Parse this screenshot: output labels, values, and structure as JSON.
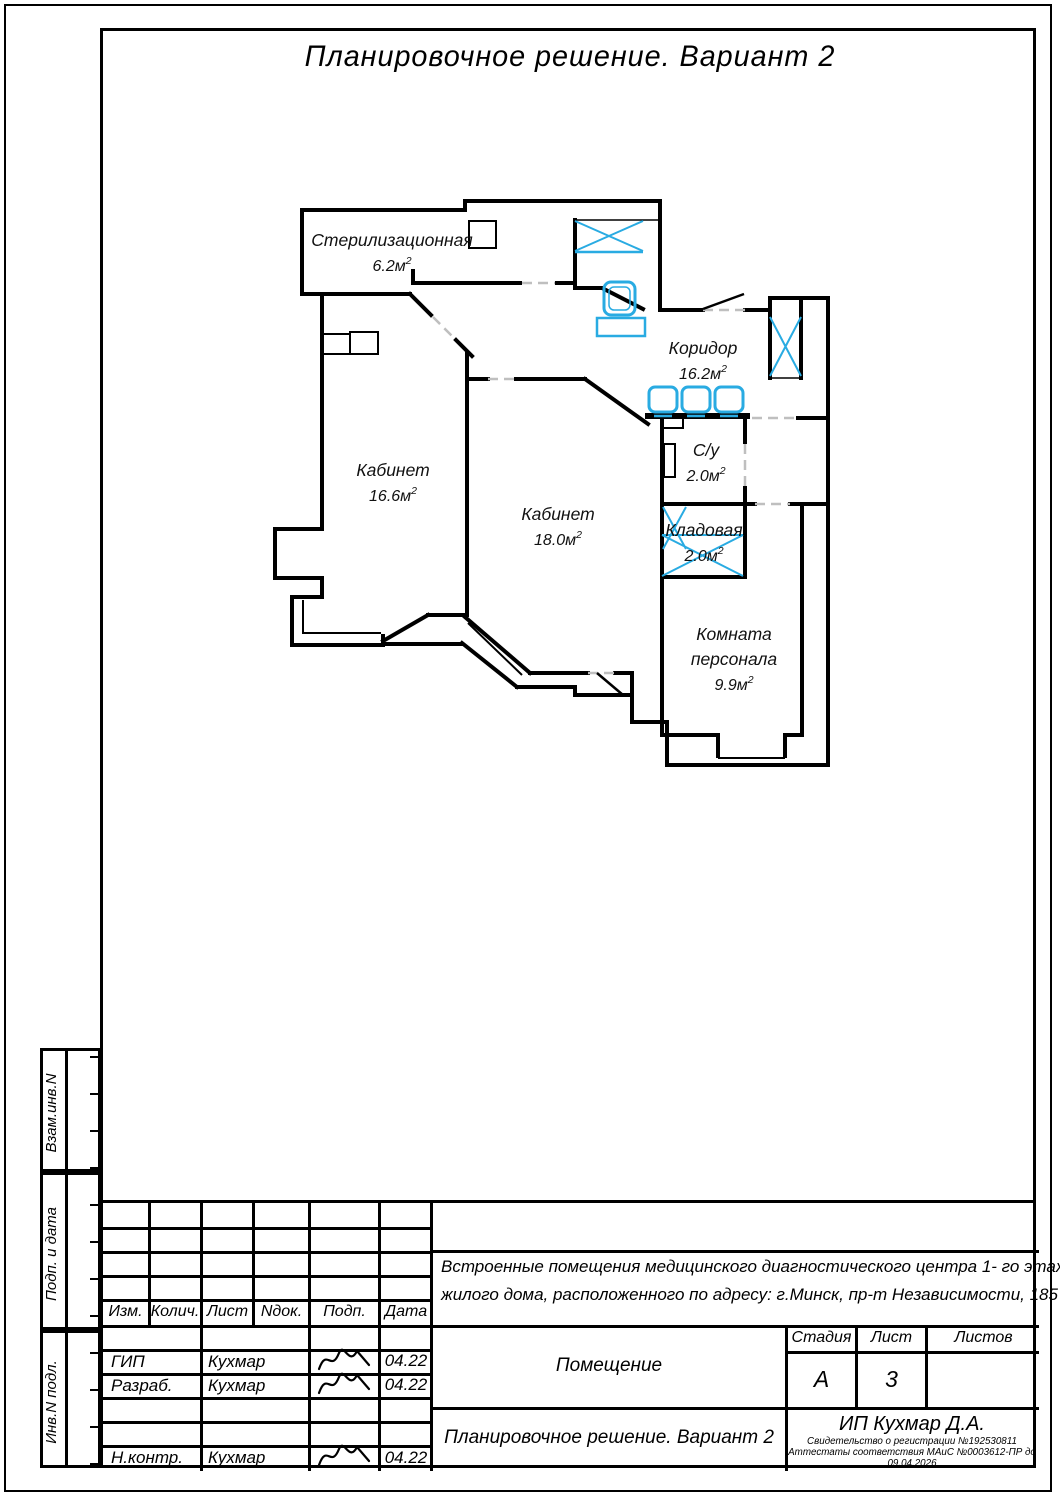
{
  "sheet_title": "Планировочное решение. Вариант 2",
  "colors": {
    "accent_blue": "#29ABE2",
    "line_black": "#000000"
  },
  "floor_plan": {
    "area_unit": "м",
    "area_sup": "2",
    "rooms": [
      {
        "name": "Стерилизационная",
        "area": "6.2",
        "x": 122,
        "y": 56
      },
      {
        "name": "Кабинет",
        "area": "16.6",
        "x": 123,
        "y": 286
      },
      {
        "name": "Кабинет",
        "area": "18.0",
        "x": 288,
        "y": 330
      },
      {
        "name": "Коридор",
        "area": "16.2",
        "x": 433,
        "y": 164
      },
      {
        "name": "С/у",
        "area": "2.0",
        "x": 436,
        "y": 266
      },
      {
        "name": "Кладовая",
        "area": "2.0",
        "x": 434,
        "y": 346
      },
      {
        "name": "Комната персонала",
        "area": "9.9",
        "x": 464,
        "y": 450
      }
    ]
  },
  "side_strip": {
    "labels": [
      "Взам.инв.N",
      "Подп. и дата",
      "Инв.N подл."
    ]
  },
  "title_block": {
    "columns": [
      "Изм.",
      "Колич.",
      "Лист",
      "Nдок.",
      "Подп.",
      "Дата"
    ],
    "rows": [
      {
        "role": "",
        "name": "",
        "date": "",
        "sig": false
      },
      {
        "role": "ГИП",
        "name": "Кухмар",
        "date": "04.22",
        "sig": true
      },
      {
        "role": "Разраб.",
        "name": "Кухмар",
        "date": "04.22",
        "sig": true
      },
      {
        "role": "",
        "name": "",
        "date": "",
        "sig": false
      },
      {
        "role": "",
        "name": "",
        "date": "",
        "sig": false
      },
      {
        "role": "Н.контр.",
        "name": "Кухмар",
        "date": "04.22",
        "sig": true
      }
    ],
    "project_lines": [
      "Встроенные помещения медицинского диагностического центра  1- го этажа",
      "жилого дома, расположенного по адресу: г.Минск, пр-т Независимости, 185"
    ],
    "object_label": "Помещение",
    "stage_label": "Стадия",
    "sheet_label": "Лист",
    "sheets_label": "Листов",
    "stage_value": "А",
    "sheet_value": "3",
    "sheets_value": "",
    "doc_title": "Планировочное решение. Вариант 2",
    "company": "ИП Кухмар Д.А.",
    "certificate": "Свидетельство о регистрации №192530811",
    "attestation": "Аттестаты соответствия МАиС №0003612-ПР до 09.04.2026"
  }
}
